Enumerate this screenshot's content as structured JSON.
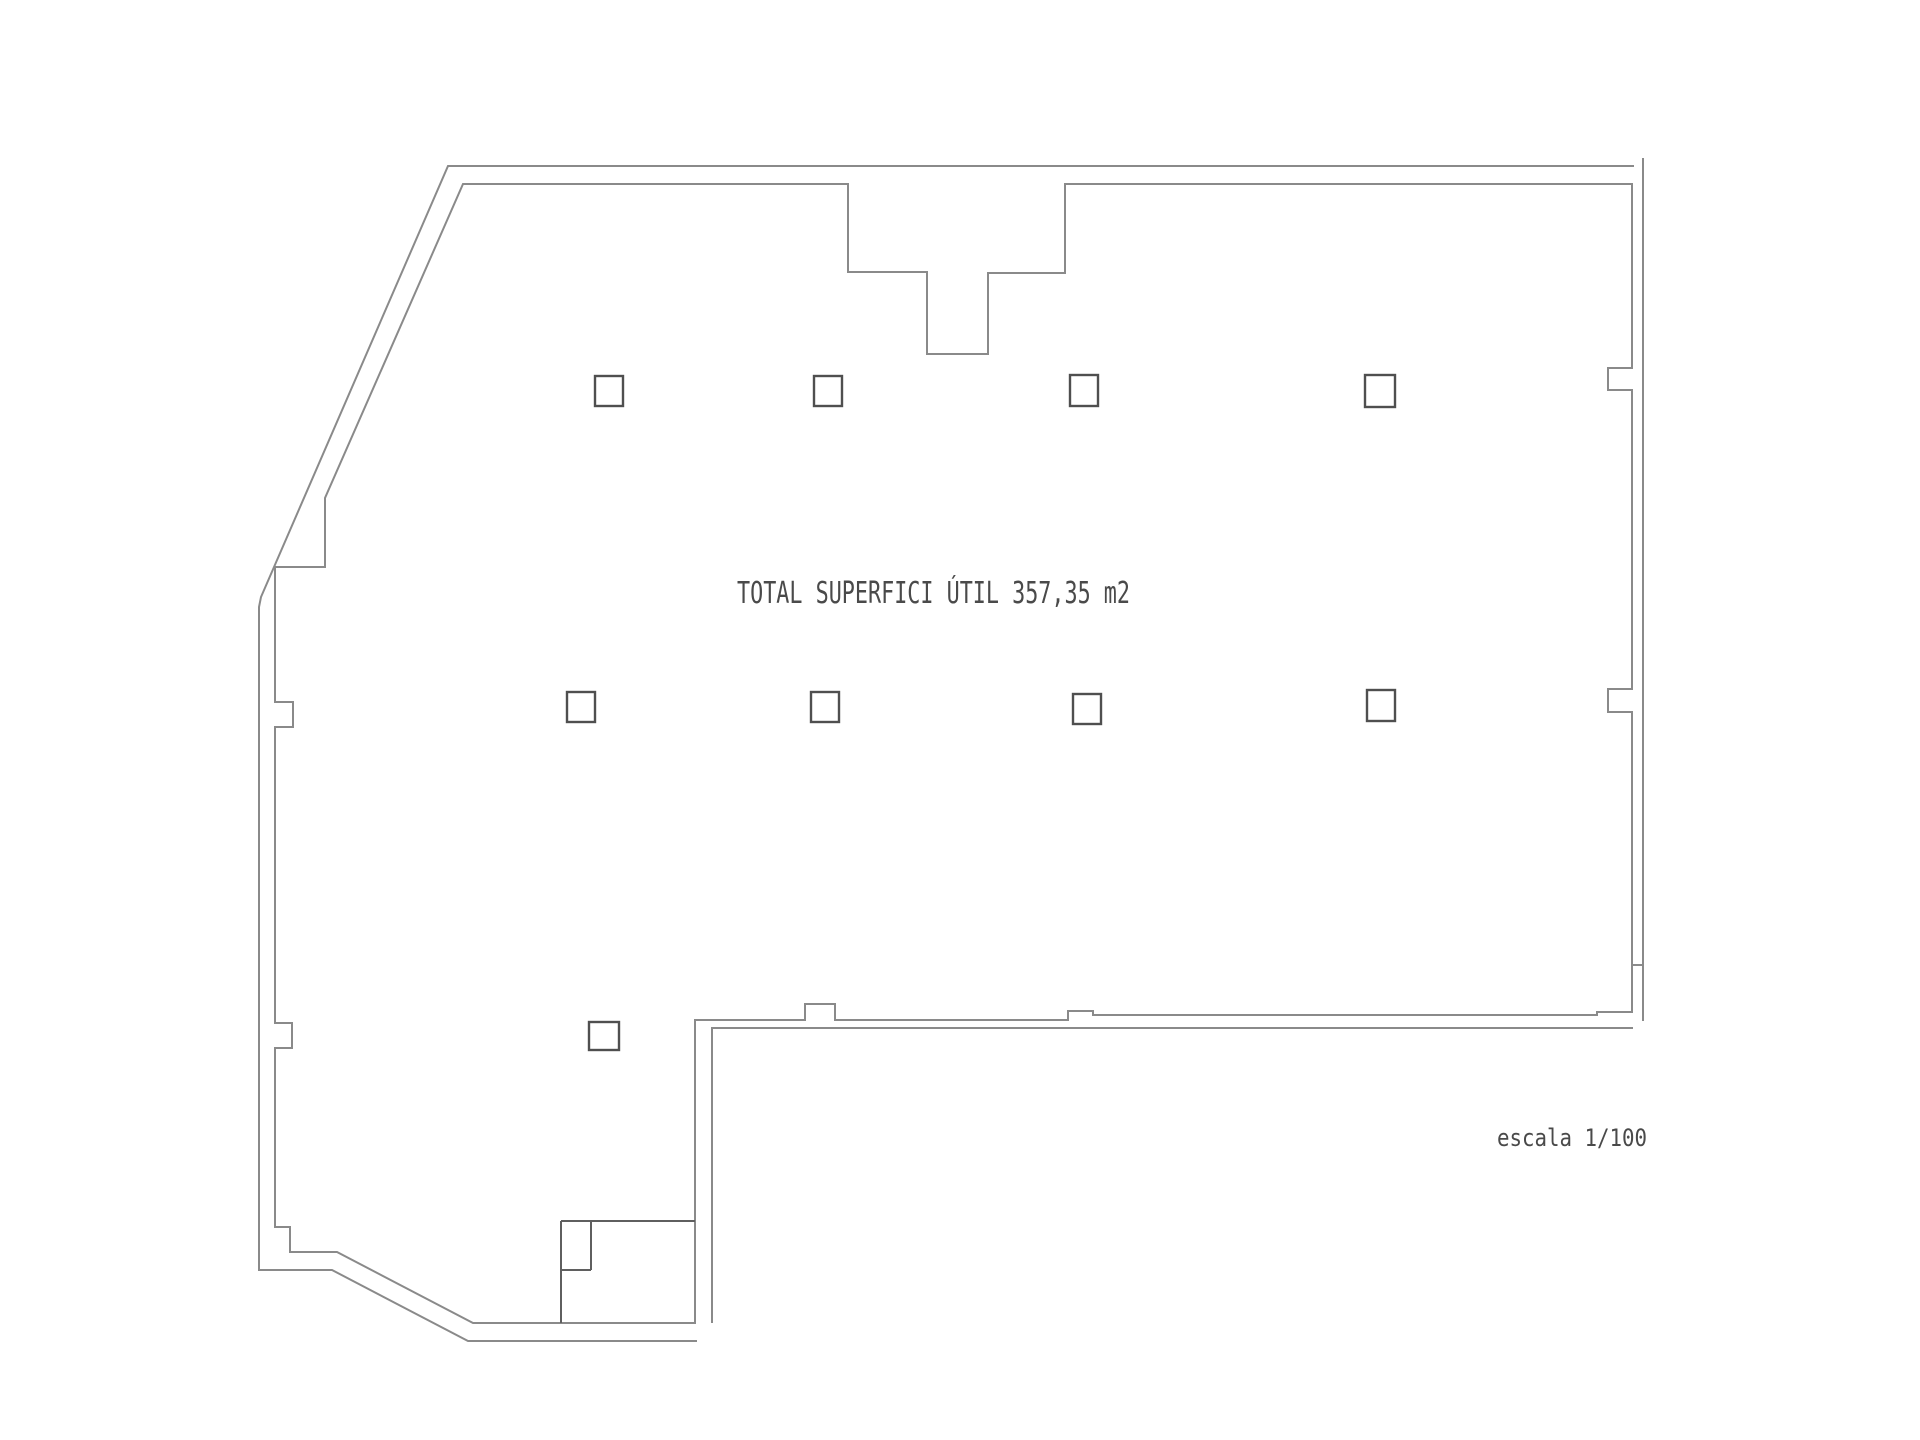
{
  "document": {
    "area_label": "TOTAL SUPERFICI ÚTIL 357,35 m2",
    "scale_label": "escala 1/100",
    "total_area_m2": "357,35",
    "scale": "1/100"
  },
  "plan": {
    "column_marker_count": 9,
    "column_rows": [
      4,
      4,
      1
    ],
    "wall_notch_count": 5,
    "has_stair_recess_top": true,
    "has_subroom_bottom_left": true
  },
  "colors": {
    "background": "#ffffff",
    "wall_line": "#8a8a8a",
    "partition_line": "#5f5f5f",
    "column_line": "#4f4f4f",
    "text": "#4a4a4a"
  }
}
